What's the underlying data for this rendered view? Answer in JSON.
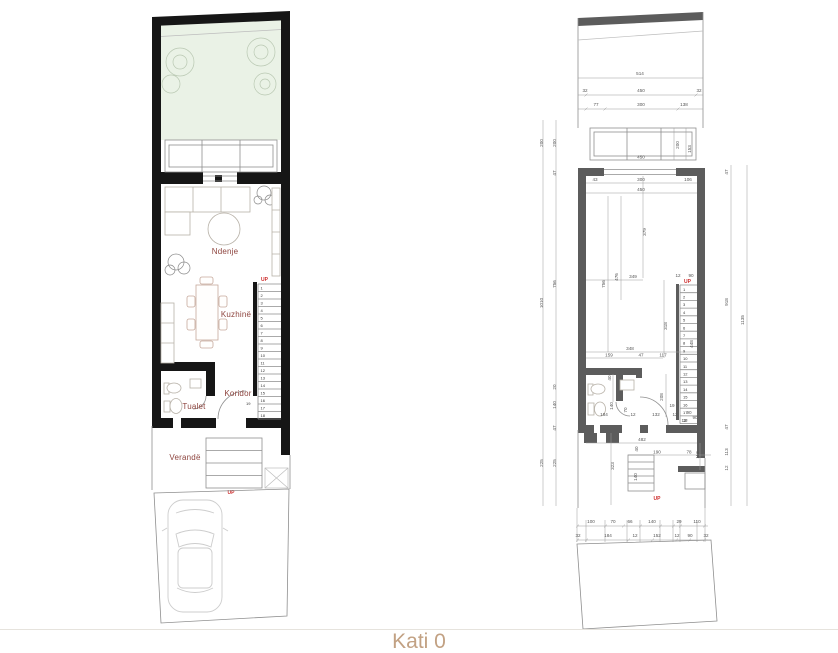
{
  "caption": "Kati 0",
  "colors": {
    "left_wall": "#161616",
    "right_wall": "#5c5c5c",
    "garden_fill": "#eaf2e6",
    "room_label": "#8e453f",
    "up_red": "#cc2a2a",
    "dimension_text": "#555555",
    "caption_tan": "#c2a183"
  },
  "left_plan": {
    "labels": {
      "living": "Ndenje",
      "kitchen": "Kuzhinë",
      "corridor": "Koridor",
      "toilet": "Tualet",
      "veranda": "Verandë"
    },
    "up_stairs": "UP",
    "up_entry": "UP",
    "tread_dim": "19",
    "stairs": [
      "1",
      "2",
      "3",
      "4",
      "5",
      "6",
      "7",
      "8",
      "9",
      "10",
      "11",
      "12",
      "13",
      "14",
      "15",
      "16",
      "17",
      "18"
    ]
  },
  "right_plan": {
    "up_stairs": "UP",
    "up_entry": "UP",
    "stairs": [
      "1",
      "2",
      "3",
      "4",
      "5",
      "6",
      "7",
      "8",
      "9",
      "10",
      "11",
      "12",
      "13",
      "14",
      "15",
      "16",
      "17",
      "18"
    ],
    "dims_garden": [
      "514",
      "32",
      "450",
      "32",
      "77",
      "300",
      "138"
    ],
    "dims_band": [
      "450",
      "200",
      "153"
    ],
    "dims_left_outer": [
      "200",
      "1010",
      "225"
    ],
    "dims_left_inner": [
      "200",
      "47",
      "756",
      "20",
      "140",
      "47",
      "225"
    ],
    "dims_right_inner": [
      "47",
      "918",
      "47",
      "113",
      "12"
    ],
    "dims_right_outer": [
      "1135"
    ],
    "dims_top_interior": [
      "43",
      "300",
      "106",
      "450"
    ],
    "dims_mid": [
      "379",
      "756",
      "476",
      "349",
      "12",
      "90",
      "448",
      "348",
      "159",
      "47",
      "117",
      "318"
    ],
    "dims_bath": [
      "40",
      "140",
      "70",
      "208",
      "184",
      "12",
      "132",
      "12",
      "90",
      "19",
      "12",
      "90"
    ],
    "dims_entry": [
      "482",
      "40",
      "190",
      "78",
      "113",
      "323",
      "140"
    ],
    "dims_bottom_upper": [
      "100",
      "70",
      "66",
      "140",
      "29",
      "110"
    ],
    "dims_bottom_lower": [
      "32",
      "184",
      "12",
      "152",
      "12",
      "90",
      "32"
    ]
  }
}
